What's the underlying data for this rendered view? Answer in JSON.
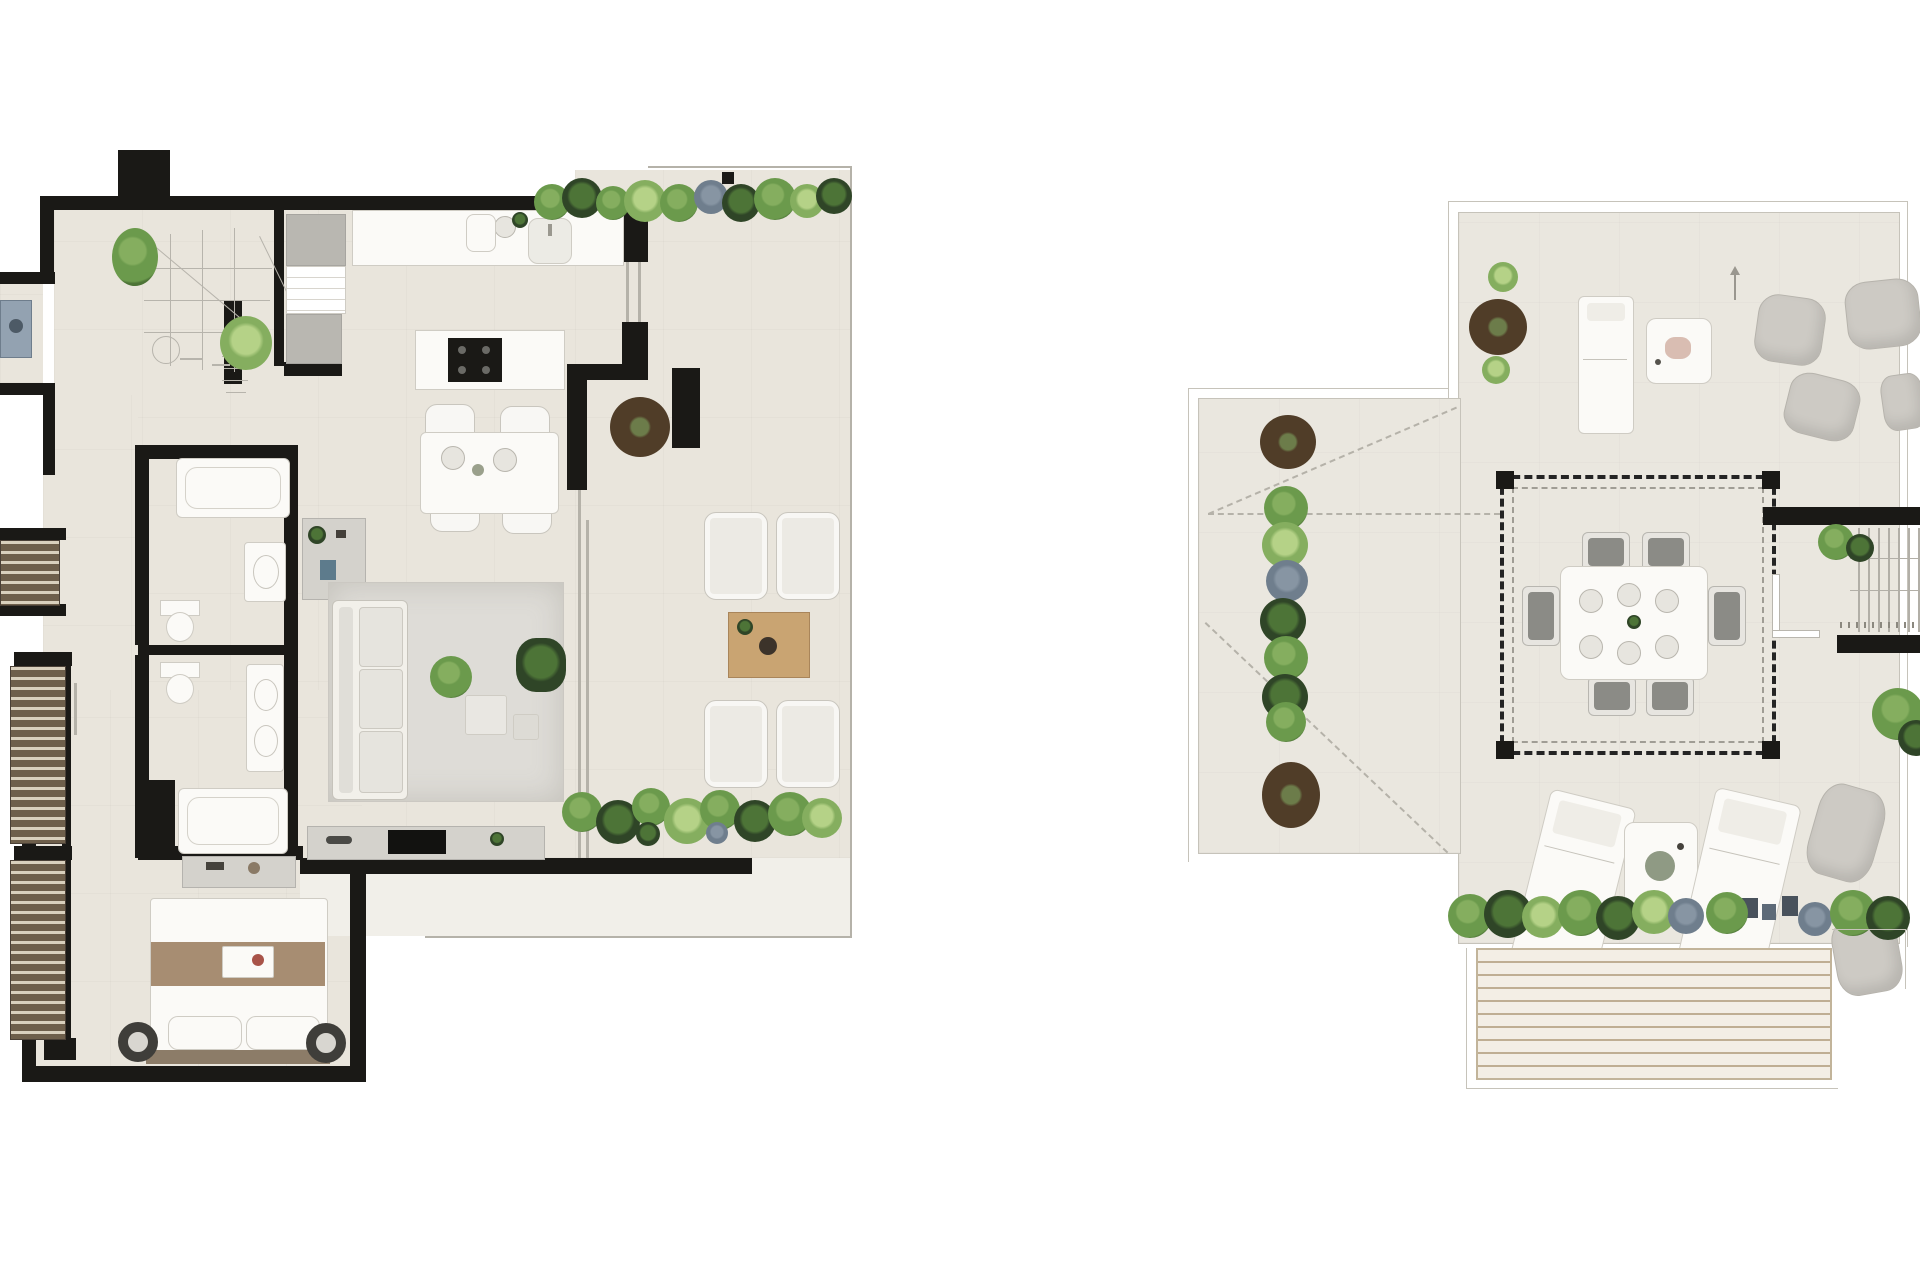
{
  "document": {
    "kind": "architectural floor plan sheet",
    "visible_text": "none (only illegible hand-sketch stair step numbers and tiny dimension marks)",
    "background": "#ffffff"
  },
  "palette": {
    "floor": "#e9e5dc",
    "floor2": "#eae7df",
    "wall": "#1a1916",
    "line": "#c6c3ba",
    "white_item": "#fbfaf7",
    "white_border": "#cfccc4",
    "gray_item": "#b9b7b1",
    "rug": "#dedcd7",
    "wood": "#c9a472",
    "blanket": "#a78d72",
    "headboard": "#8c7c68",
    "louver_dark": "#6e5f4b",
    "louver_light": "#d9d0bd",
    "plant_green_1": "#6b9a4c",
    "plant_green_2": "#4d7437",
    "plant_green_3": "#85ae5f",
    "plant_green_4": "#2f4527",
    "plant_blue": "#6f7e8d",
    "planter_brown": "#503d28",
    "planter_core": "#6c7c4a",
    "dash_dark": "#242424",
    "dash_light": "#b5b2a9",
    "deck_base": "#f3eee5",
    "deck_slat": "#bfae93",
    "cushion": "#8b8b86"
  },
  "plans": [
    {
      "id": "apartment-level",
      "position": "left",
      "contents": [
        "winder-staircase-sketch",
        "entry-hall",
        "two-wall-closets",
        "kitchen-counter-with-sink",
        "kitchen-island-with-cooktop",
        "dining-table-4-chairs",
        "round-planter",
        "living-room-rug-sofa",
        "console-table",
        "tv-sideboard",
        "bathroom-1-tub-sink-wc",
        "bathroom-2-wc-vanity-tub",
        "hall-wardrobes-louvered",
        "washer-nook",
        "master-bed-nightstand-lamps",
        "dresser",
        "terrace-with-4-armchairs",
        "wood-coffee-table",
        "terrace-planting-top",
        "terrace-planting-bottom",
        "glass-sliding-doors"
      ]
    },
    {
      "id": "roof-terrace-level",
      "position": "right",
      "contents": [
        "parapet-outline",
        "roof-projection-dashed-lines",
        "pergola-dashed-with-posts",
        "outdoor-dining-table-6-chairs",
        "stair-well-with-steps",
        "stair-handrail",
        "round-planters-3",
        "hedge-column-left",
        "hedge-row-bottom",
        "sun-lounger-top",
        "side-tables",
        "bean-bag-poufs-6",
        "sun-loungers-bottom-2",
        "wood-slat-deck",
        "north-arrow",
        "grass-tufts"
      ]
    }
  ]
}
